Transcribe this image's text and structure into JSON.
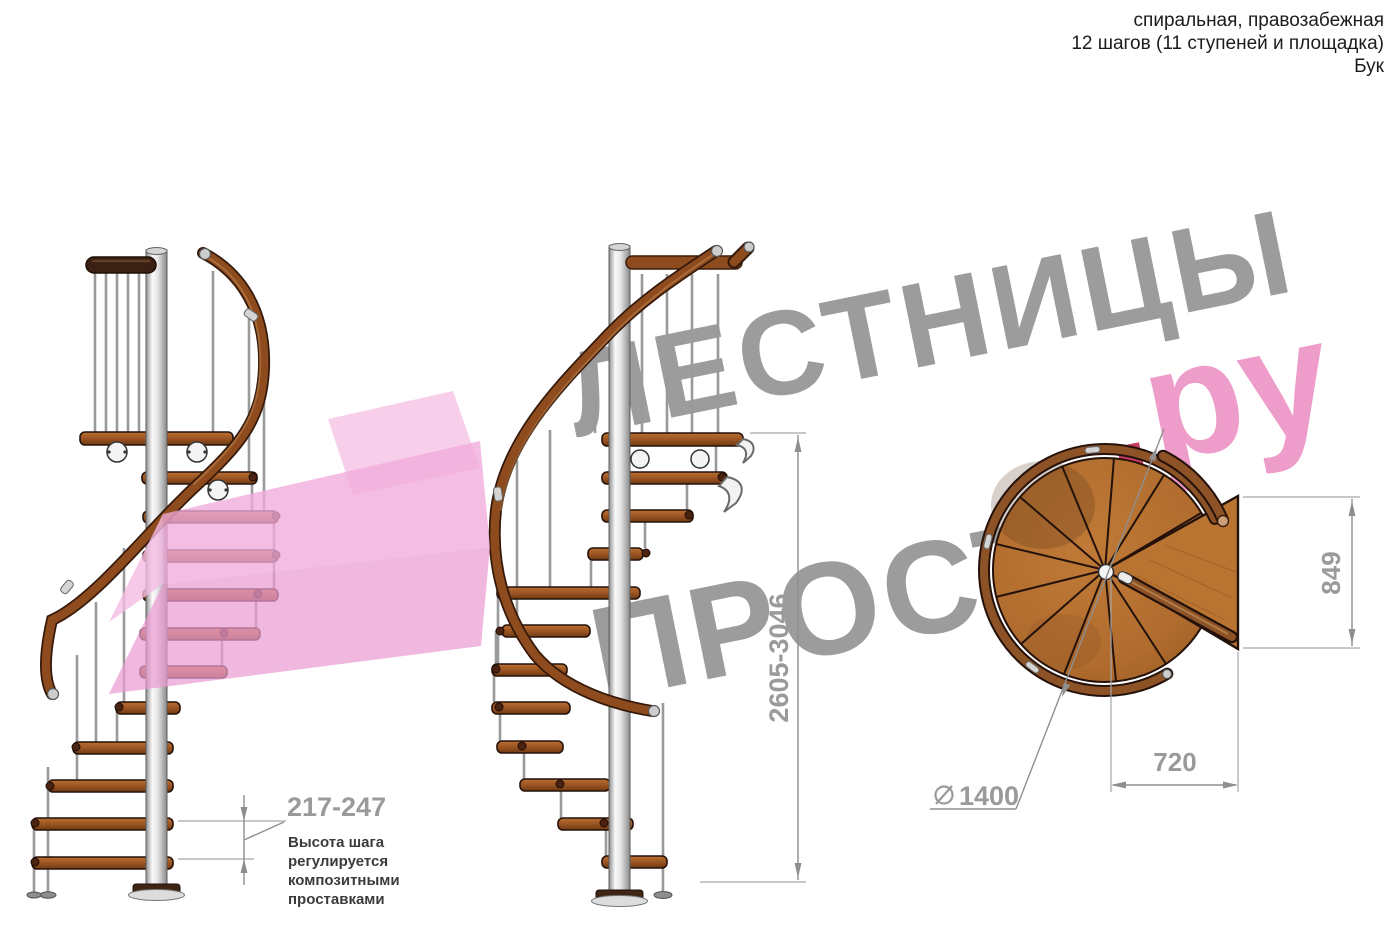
{
  "header": {
    "line1": "спиральная, правозабежная",
    "line2": "12 шагов (11 ступеней и площадка)",
    "line3": "Бук"
  },
  "watermark": {
    "word_top": "ЛЕСТНИЦЫ",
    "word_bottom": "ПРОСТО",
    "dot": ".",
    "domain_suffix": "ру"
  },
  "dimensions": {
    "total_height": "2605-3046",
    "step_height": "217-247",
    "note_line1": "Высота шага",
    "note_line2": "регулируется",
    "note_line3": "композитными",
    "note_line4": "проставками",
    "plan_depth": "849",
    "plan_width": "720",
    "plan_diameter": "1400"
  },
  "colors": {
    "watermark_gray": "#9c9c9c",
    "watermark_pink": "#ee9cc9",
    "dot_red": "#c43a60",
    "dimension_gray": "#9a9a9a",
    "wood": "#b06c2e",
    "arrow_pink": "#f1aadb"
  }
}
